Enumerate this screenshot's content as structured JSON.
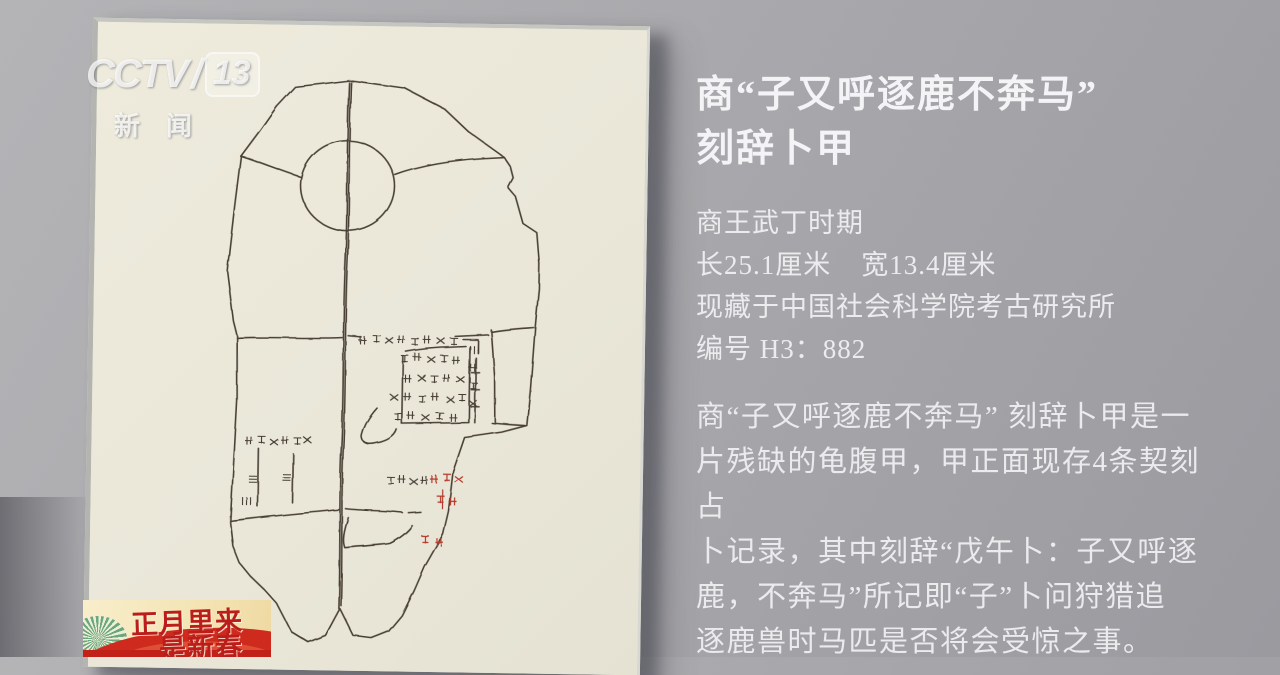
{
  "broadcast": {
    "logo": {
      "channel": "CCTV",
      "slash": "/",
      "number": "13",
      "subtitle": "新闻"
    },
    "banner": {
      "line1": "正月里来",
      "line2": "是新春"
    }
  },
  "artifact_panel": {
    "title_lines": [
      "商“子又呼逐鹿不奔马”",
      "刻辞卜甲"
    ],
    "details": {
      "era": "商王武丁时期",
      "length": "长25.1厘米",
      "width": "宽13.4厘米",
      "collection": "现藏于中国社会科学院考古研究所",
      "catalog_no": "编号 H3：882"
    },
    "paragraph_lines": [
      "商“子又呼逐鹿不奔马” 刻辞卜甲是一",
      "片残缺的龟腹甲，甲正面现存4条契刻占",
      "卜记录，其中刻辞“戊午卜：子又呼逐",
      "鹿，不奔马”所记即“子”卜问狩猎追",
      "逐鹿兽时马匹是否将会受惊之事。"
    ]
  },
  "artwork": {
    "subject": "oracle-bone-plastron-line-drawing",
    "ink_color": "#4a4036",
    "red_ink_color": "#b5372c",
    "paper_color": "#ebe8da",
    "wall_color": "#a9a9ad"
  }
}
